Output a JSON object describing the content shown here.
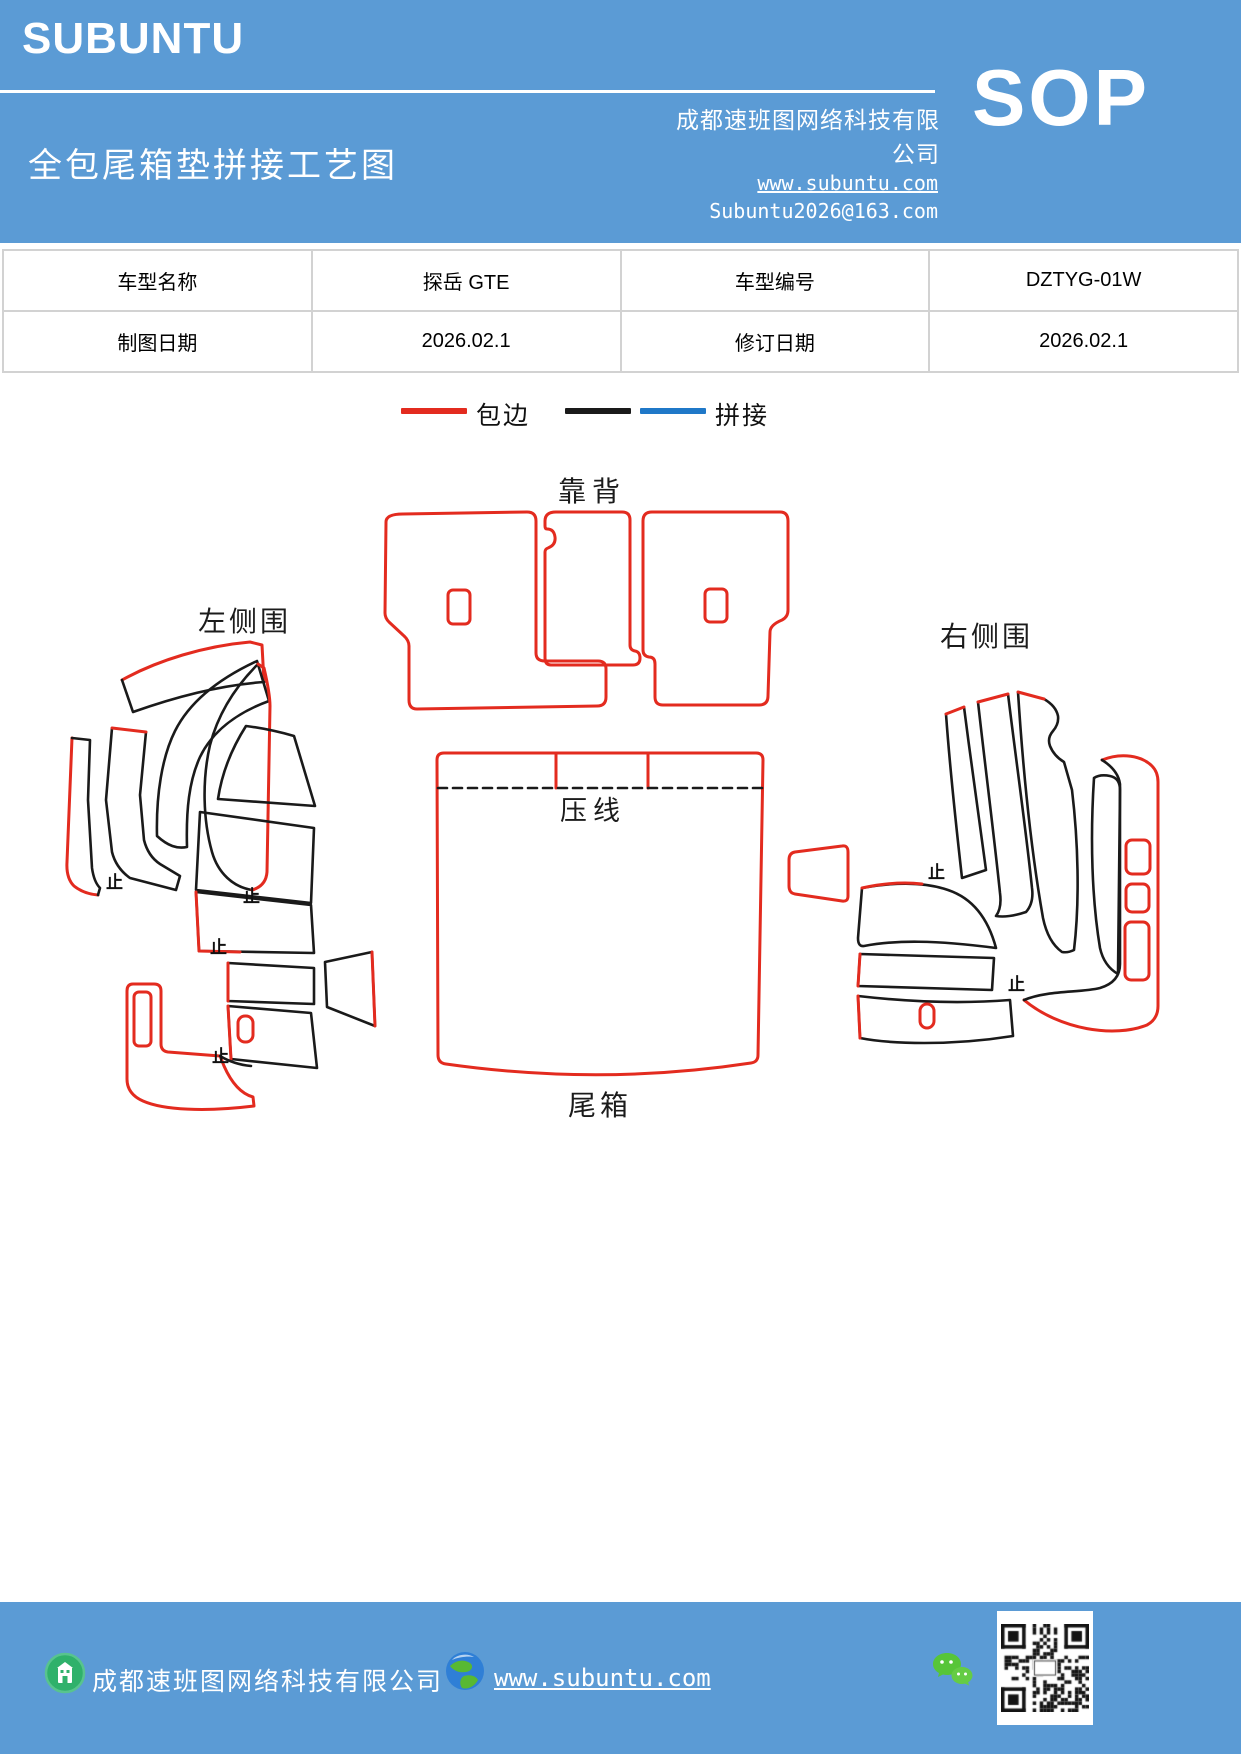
{
  "header": {
    "logo": "SUBUNTU",
    "company": "成都速班图网络科技有限公司",
    "title": "全包尾箱垫拼接工艺图",
    "website": "www.subuntu.com",
    "email": "Subuntu2026@163.com",
    "sop": "SOP"
  },
  "table": {
    "rows": [
      {
        "cells": [
          "车型名称",
          "探岳 GTE",
          "车型编号",
          "DZTYG-01W"
        ]
      },
      {
        "cells": [
          "制图日期",
          "2026.02.1",
          "修订日期",
          "2026.02.1"
        ]
      }
    ]
  },
  "legend": {
    "items": [
      {
        "label": "包边",
        "colors": [
          "#e32b1f"
        ]
      },
      {
        "label": "拼接",
        "colors": [
          "#1a1a1a",
          "#1f78c8"
        ]
      }
    ]
  },
  "diagram": {
    "labels": {
      "backrest": "靠背",
      "left_side": "左侧围",
      "right_side": "右侧围",
      "crease": "压线",
      "trunk": "尾箱"
    },
    "stop_mark": "止",
    "colors": {
      "binding_red": "#e32b1f",
      "stitch_black": "#1a1a1a",
      "stitch_blue": "#1f78c8",
      "band_blue": "#5b9bd5"
    }
  },
  "footer": {
    "company": "成都速班图网络科技有限公司",
    "website": "www.subuntu.com"
  }
}
